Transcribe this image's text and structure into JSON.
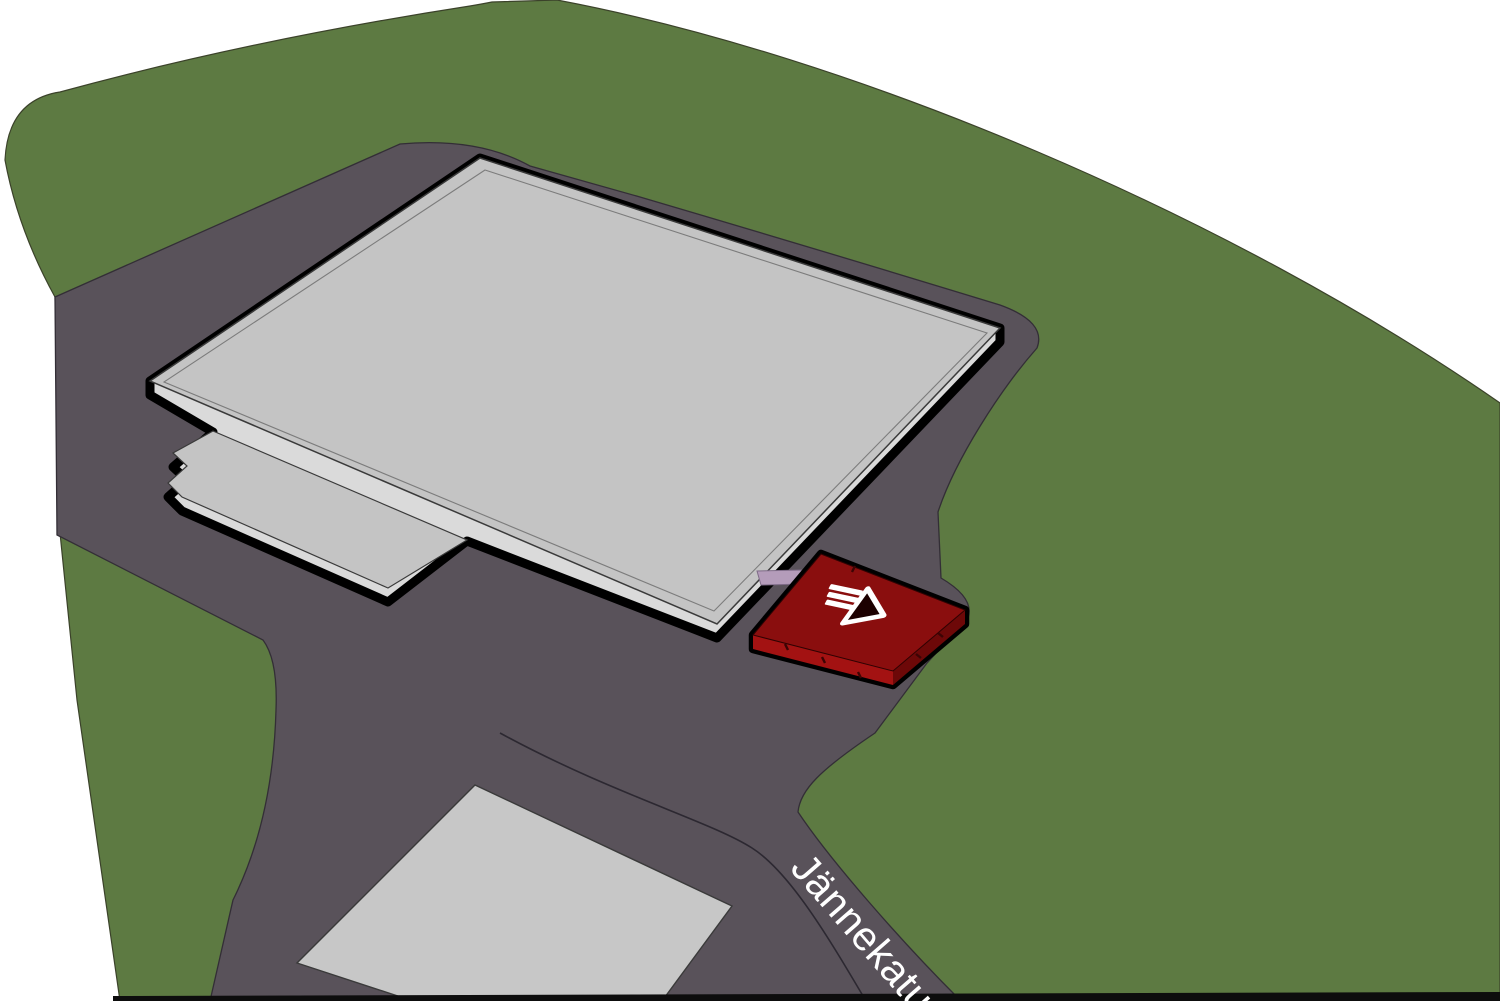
{
  "map": {
    "street_label": "Jännekatu",
    "marker_icon": "entrance-arrow-icon"
  },
  "colors": {
    "background": "#ffffff",
    "grass": "#5d7a42",
    "grass_outline": "#3b422a",
    "road": "#59525a",
    "road_outline": "#332e36",
    "street_line": "#2c2831",
    "building_top": "#c4c4c4",
    "building_side": "#dadada",
    "building_edge": "#3a3a3a",
    "building_outline": "#000000",
    "flat_building": "#c7c7c7",
    "walkway": "#b49cba",
    "marker_top": "#8a0e0e",
    "marker_side_dark": "#6d0808",
    "marker_side_light": "#a31212",
    "marker_base": "#9b1313",
    "ground_edge": "#0d0d0d",
    "label_text": "#ffffff"
  }
}
